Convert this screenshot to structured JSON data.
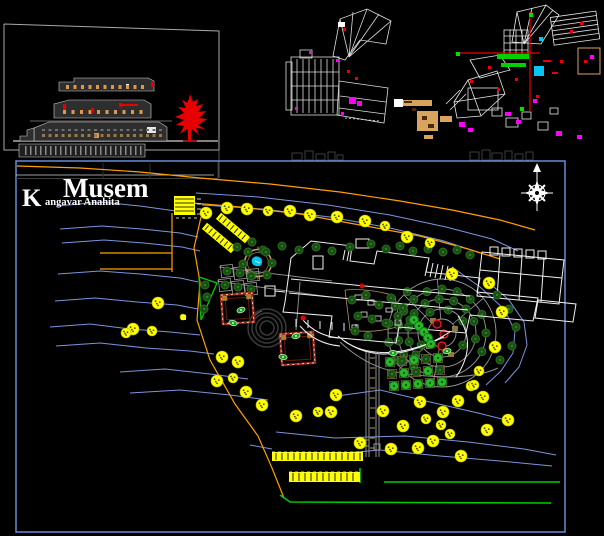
{
  "title": {
    "main": "Musem",
    "sub_initial": "K",
    "sub_rest": "angavar Anahita"
  },
  "colors": {
    "background": "#000000",
    "border_blue": "#6d97e3",
    "contour_blue": "#7b94de",
    "orange": "#ff9f00",
    "yellow": "#ffff00",
    "green": "#00cc00",
    "bright_green": "#29b829",
    "dark_green": "#174f12",
    "white": "#f2f2f2",
    "gray": "#9a9a9a",
    "red": "#ff1a1a",
    "dark_red": "#9c2a16",
    "magenta": "#ff00ff",
    "cyan": "#00c8f0",
    "tan": "#d9a55e",
    "khaki": "#8a7a40"
  },
  "main_panel": {
    "x": 16,
    "y": 161,
    "w": 549,
    "h": 371
  },
  "compass": {
    "cx": 537,
    "cy": 193
  },
  "contours": [
    [
      [
        58,
        206
      ],
      [
        100,
        202
      ],
      [
        140,
        206
      ],
      [
        176,
        211
      ],
      [
        196,
        214
      ]
    ],
    [
      [
        60,
        229
      ],
      [
        102,
        226
      ],
      [
        142,
        229
      ],
      [
        180,
        233
      ],
      [
        198,
        237
      ]
    ],
    [
      [
        62,
        243
      ],
      [
        104,
        240
      ],
      [
        144,
        243
      ],
      [
        182,
        247
      ],
      [
        200,
        251
      ]
    ],
    [
      [
        58,
        274
      ],
      [
        100,
        271
      ],
      [
        140,
        274
      ],
      [
        180,
        278
      ],
      [
        198,
        282
      ]
    ],
    [
      [
        55,
        301
      ],
      [
        95,
        298
      ],
      [
        137,
        302
      ],
      [
        177,
        305
      ],
      [
        198,
        309
      ]
    ],
    [
      [
        50,
        327
      ],
      [
        90,
        324
      ],
      [
        130,
        329
      ],
      [
        170,
        332
      ],
      [
        200,
        335
      ]
    ],
    [
      [
        56,
        346
      ],
      [
        100,
        343
      ],
      [
        146,
        348
      ],
      [
        190,
        351
      ],
      [
        214,
        354
      ]
    ],
    [
      [
        120,
        372
      ],
      [
        165,
        369
      ],
      [
        210,
        374
      ],
      [
        248,
        379
      ]
    ],
    [
      [
        130,
        393
      ],
      [
        180,
        390
      ],
      [
        230,
        395
      ],
      [
        268,
        400
      ]
    ],
    [
      [
        196,
        193
      ],
      [
        258,
        197
      ],
      [
        328,
        205
      ],
      [
        390,
        215
      ],
      [
        446,
        227
      ],
      [
        492,
        239
      ],
      [
        518,
        251
      ]
    ],
    [
      [
        202,
        205
      ],
      [
        262,
        209
      ],
      [
        330,
        217
      ],
      [
        390,
        228
      ],
      [
        444,
        241
      ],
      [
        480,
        253
      ]
    ],
    [
      [
        452,
        267
      ],
      [
        480,
        287
      ],
      [
        504,
        309
      ],
      [
        515,
        331
      ],
      [
        513,
        353
      ],
      [
        501,
        371
      ],
      [
        486,
        385
      ]
    ],
    [
      [
        487,
        281
      ],
      [
        509,
        300
      ],
      [
        524,
        322
      ],
      [
        527,
        345
      ],
      [
        519,
        367
      ],
      [
        505,
        383
      ]
    ],
    [
      [
        330,
        397
      ],
      [
        380,
        390
      ],
      [
        430,
        402
      ],
      [
        478,
        413
      ],
      [
        510,
        421
      ]
    ],
    [
      [
        276,
        432
      ],
      [
        335,
        438
      ],
      [
        405,
        436
      ],
      [
        468,
        442
      ],
      [
        524,
        449
      ],
      [
        556,
        455
      ]
    ],
    [
      [
        322,
        455
      ],
      [
        380,
        450
      ],
      [
        440,
        456
      ],
      [
        500,
        461
      ],
      [
        552,
        466
      ]
    ],
    [
      [
        250,
        445
      ],
      [
        272,
        449
      ]
    ]
  ],
  "orange_lines": [
    [
      [
        17,
        166
      ],
      [
        80,
        168
      ],
      [
        140,
        172
      ],
      [
        200,
        178
      ],
      [
        270,
        184
      ],
      [
        340,
        192
      ],
      [
        400,
        201
      ],
      [
        452,
        210
      ],
      [
        500,
        220
      ],
      [
        535,
        230
      ]
    ],
    [
      [
        180,
        202
      ],
      [
        240,
        207
      ],
      [
        300,
        214
      ],
      [
        360,
        225
      ],
      [
        420,
        236
      ],
      [
        468,
        249
      ],
      [
        500,
        259
      ]
    ],
    [
      [
        100,
        253
      ],
      [
        172,
        253
      ]
    ],
    [
      [
        100,
        269
      ],
      [
        172,
        269
      ]
    ],
    [
      [
        172,
        213
      ],
      [
        172,
        272
      ]
    ],
    [
      [
        201,
        217
      ],
      [
        194,
        248
      ],
      [
        200,
        282
      ],
      [
        197,
        320
      ],
      [
        210,
        360
      ],
      [
        235,
        404
      ],
      [
        258,
        436
      ],
      [
        272,
        468
      ],
      [
        284,
        498
      ]
    ]
  ],
  "green_lines": [
    [
      [
        280,
        495
      ],
      [
        290,
        502
      ],
      [
        551,
        503
      ]
    ],
    [
      [
        384,
        482
      ],
      [
        560,
        482
      ]
    ],
    [
      [
        360,
        468
      ],
      [
        360,
        483
      ]
    ]
  ],
  "yellow_trees": [
    [
      206,
      213,
      6
    ],
    [
      227,
      208,
      6
    ],
    [
      247,
      209,
      6
    ],
    [
      268,
      211,
      5
    ],
    [
      290,
      211,
      6
    ],
    [
      310,
      215,
      6
    ],
    [
      337,
      217,
      6
    ],
    [
      365,
      221,
      6
    ],
    [
      385,
      226,
      5
    ],
    [
      407,
      237,
      6
    ],
    [
      430,
      243,
      5
    ],
    [
      452,
      274,
      6
    ],
    [
      489,
      283,
      6
    ],
    [
      502,
      312,
      6
    ],
    [
      495,
      347,
      6
    ],
    [
      479,
      371,
      5
    ],
    [
      471,
      386,
      5
    ],
    [
      158,
      303,
      6
    ],
    [
      133,
      329,
      6
    ],
    [
      152,
      331,
      5
    ],
    [
      126,
      333,
      5
    ],
    [
      222,
      357,
      6
    ],
    [
      238,
      362,
      6
    ],
    [
      217,
      381,
      6
    ],
    [
      233,
      378,
      5
    ],
    [
      246,
      392,
      6
    ],
    [
      262,
      405,
      6
    ],
    [
      183,
      317,
      3
    ],
    [
      296,
      416,
      6
    ],
    [
      318,
      412,
      5
    ],
    [
      336,
      395,
      6
    ],
    [
      331,
      412,
      6
    ],
    [
      360,
      443,
      6
    ],
    [
      383,
      411,
      6
    ],
    [
      391,
      449,
      6
    ],
    [
      403,
      426,
      6
    ],
    [
      418,
      448,
      6
    ],
    [
      420,
      402,
      6
    ],
    [
      433,
      441,
      6
    ],
    [
      443,
      412,
      6
    ],
    [
      450,
      434,
      5
    ],
    [
      461,
      456,
      6
    ],
    [
      474,
      385,
      5
    ],
    [
      487,
      430,
      6
    ],
    [
      508,
      420,
      6
    ],
    [
      458,
      401,
      6
    ],
    [
      483,
      397,
      6
    ],
    [
      426,
      419,
      5
    ],
    [
      441,
      425,
      5
    ]
  ],
  "dark_trees": [
    [
      237,
      247
    ],
    [
      252,
      242
    ],
    [
      263,
      250
    ],
    [
      282,
      246
    ],
    [
      299,
      250
    ],
    [
      316,
      247
    ],
    [
      332,
      251
    ],
    [
      350,
      247
    ],
    [
      371,
      244
    ],
    [
      386,
      249
    ],
    [
      400,
      246
    ],
    [
      413,
      251
    ],
    [
      428,
      249
    ],
    [
      443,
      252
    ],
    [
      457,
      250
    ],
    [
      470,
      255
    ],
    [
      248,
      252
    ],
    [
      266,
      252
    ],
    [
      272,
      263
    ],
    [
      267,
      275
    ],
    [
      251,
      276
    ],
    [
      243,
      264
    ],
    [
      205,
      285
    ],
    [
      207,
      297
    ],
    [
      204,
      309
    ],
    [
      352,
      300
    ],
    [
      366,
      295
    ],
    [
      379,
      305
    ],
    [
      391,
      298
    ],
    [
      403,
      308
    ],
    [
      358,
      316
    ],
    [
      372,
      319
    ],
    [
      386,
      323
    ],
    [
      398,
      316
    ],
    [
      410,
      320
    ],
    [
      355,
      331
    ],
    [
      368,
      336
    ],
    [
      497,
      295
    ],
    [
      509,
      309
    ],
    [
      516,
      327
    ],
    [
      512,
      346
    ],
    [
      500,
      360
    ]
  ],
  "bright_trees": [
    [
      414,
      320
    ],
    [
      419,
      326
    ],
    [
      424,
      332
    ],
    [
      428,
      338
    ],
    [
      431,
      344
    ]
  ],
  "statues": [
    [
      241,
      310,
      -20
    ],
    [
      233,
      323,
      15
    ],
    [
      296,
      336,
      -15
    ],
    [
      283,
      357,
      10
    ],
    [
      393,
      353,
      0
    ],
    [
      447,
      351,
      -10
    ]
  ],
  "plan_red_dots": [
    [
      303,
      318
    ],
    [
      362,
      286
    ]
  ],
  "yellow_bars": [
    {
      "x": 272,
      "y": 452,
      "w": 91,
      "h": 9
    },
    {
      "x": 289,
      "y": 472,
      "w": 71,
      "h": 10
    }
  ],
  "yellow_block": {
    "x": 174,
    "y": 196,
    "w": 21,
    "h": 19
  },
  "yellow_strips": [
    {
      "cx": 219,
      "cy": 238,
      "w": 38,
      "h": 8,
      "rot": 40
    },
    {
      "cx": 233,
      "cy": 228,
      "w": 38,
      "h": 8,
      "rot": 40
    }
  ],
  "garden": {
    "cx": 442,
    "cy": 333,
    "rings": [
      14,
      24,
      34,
      44,
      54
    ],
    "spokes": [
      100,
      140,
      180,
      225,
      265,
      320
    ],
    "tree_rings": [
      {
        "r": 24,
        "angles": [
          150,
          195,
          240,
          285,
          330,
          30
        ]
      },
      {
        "r": 34,
        "angles": [
          140,
          165,
          190,
          215,
          240,
          265,
          290,
          315,
          340,
          10
        ]
      },
      {
        "r": 44,
        "angles": [
          130,
          150,
          170,
          190,
          210,
          230,
          250,
          270,
          290,
          310,
          335,
          0,
          25
        ]
      },
      {
        "r": 54,
        "angles": [
          150,
          170,
          190,
          210,
          230
        ]
      }
    ],
    "red_circles": [
      [
        437,
        324,
        4
      ],
      [
        444,
        334,
        4
      ],
      [
        442,
        346,
        4
      ]
    ],
    "patches": [
      [
        430,
        318
      ],
      [
        452,
        326
      ],
      [
        448,
        352
      ],
      [
        426,
        344
      ]
    ]
  },
  "orchard": {
    "x0": 390,
    "y0": 362,
    "cols": 5,
    "rows": 3,
    "dx": 12,
    "dy": 12,
    "skew": 2
  },
  "plots": [
    [
      227,
      271
    ],
    [
      240,
      273
    ],
    [
      253,
      275
    ],
    [
      225,
      285
    ],
    [
      238,
      287
    ],
    [
      251,
      289
    ]
  ],
  "pond": {
    "cx": 258,
    "cy": 263,
    "r": 13.5
  },
  "amphitheater": {
    "cx": 267,
    "cy": 328,
    "radii": [
      7,
      11,
      15,
      19
    ]
  },
  "courtyards": [
    {
      "x": 222,
      "y": 294,
      "w": 31,
      "h": 29,
      "rot": -4
    },
    {
      "x": 281,
      "y": 333,
      "w": 33,
      "h": 31,
      "rot": -4
    }
  ],
  "triangle": [
    [
      199,
      277
    ],
    [
      217,
      283
    ],
    [
      201,
      320
    ]
  ],
  "elevation_dots": [
    {
      "x": 66,
      "y": 85,
      "n": 11,
      "dx": 7.5,
      "w": 3,
      "h": 4,
      "c": "#d99a4a"
    },
    {
      "x": 63,
      "y": 110,
      "n": 10,
      "dx": 8.5,
      "w": 3,
      "h": 4,
      "c": "#d99a4a"
    },
    {
      "x": 42,
      "y": 129,
      "n": 19,
      "dx": 6.5,
      "w": 3,
      "h": 2,
      "c": "#6f6f6f"
    },
    {
      "x": 42,
      "y": 134,
      "n": 19,
      "dx": 6.5,
      "w": 3,
      "h": 3,
      "c": "#9a7848"
    },
    {
      "x": 25,
      "y": 146,
      "n": 24,
      "dx": 5,
      "w": 1.5,
      "h": 9,
      "c": "#8a8a8a"
    }
  ],
  "elevation_red_marks": [
    [
      151,
      82,
      3,
      5
    ],
    [
      63,
      104,
      3,
      6
    ],
    [
      91,
      108,
      3,
      5
    ],
    [
      119,
      103,
      3,
      4
    ],
    [
      122,
      104,
      16,
      2
    ]
  ],
  "magenta_marks": [
    [
      309,
      51
    ],
    [
      336,
      59
    ],
    [
      295,
      107
    ],
    [
      341,
      112
    ],
    [
      349,
      97,
      7,
      7
    ],
    [
      357,
      101,
      5,
      5
    ],
    [
      459,
      122,
      6,
      5
    ],
    [
      468,
      128,
      5,
      4
    ],
    [
      505,
      112,
      6,
      4
    ],
    [
      516,
      120,
      5,
      4
    ],
    [
      533,
      99,
      4,
      4
    ],
    [
      556,
      131,
      6,
      5
    ],
    [
      577,
      135,
      5,
      4
    ],
    [
      590,
      55,
      4,
      4
    ]
  ],
  "red_marks": [
    [
      343,
      28,
      3,
      3
    ],
    [
      347,
      70,
      3,
      3
    ],
    [
      355,
      77,
      3,
      3
    ],
    [
      470,
      80
    ],
    [
      488,
      66
    ],
    [
      497,
      88
    ],
    [
      515,
      78
    ],
    [
      543,
      60,
      8,
      2
    ],
    [
      552,
      72,
      6,
      2
    ],
    [
      560,
      60
    ],
    [
      570,
      30
    ],
    [
      580,
      22
    ],
    [
      584,
      60
    ],
    [
      536,
      95
    ]
  ],
  "green_squares": [
    [
      529,
      13
    ],
    [
      456,
      52
    ],
    [
      520,
      107
    ]
  ],
  "green_bars": [
    [
      497,
      54,
      32,
      5
    ],
    [
      501,
      63,
      25,
      4
    ]
  ],
  "cyan_patches": [
    [
      534,
      66,
      10,
      10
    ],
    [
      539,
      37,
      4,
      4
    ]
  ],
  "tan_fill_rects": [
    [
      398,
      100,
      34,
      6
    ],
    [
      417,
      111,
      21,
      20
    ],
    [
      440,
      116,
      12,
      6
    ],
    [
      424,
      135,
      9,
      4
    ]
  ],
  "tan_stroke_rects": [
    [
      578,
      48,
      22,
      26
    ]
  ],
  "dark_spots": [
    [
      422,
      116,
      5,
      4
    ],
    [
      428,
      124,
      6,
      4
    ],
    [
      412,
      108,
      4,
      3
    ],
    [
      404,
      101,
      8,
      2
    ]
  ]
}
